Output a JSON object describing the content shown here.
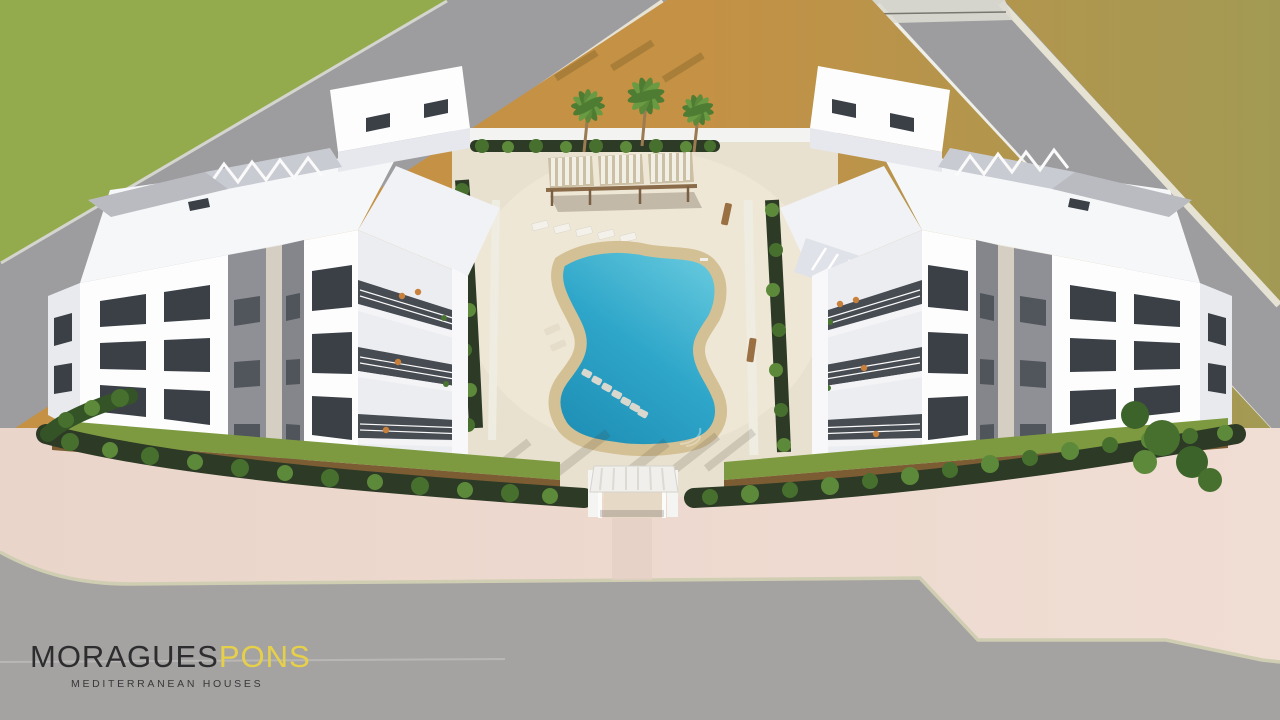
{
  "branding": {
    "wordmark_primary": "MORAGUES",
    "wordmark_secondary": "PONS",
    "tagline": "MEDITERRANEAN HOUSES"
  },
  "scene": {
    "type": "aerial 3D architectural rendering",
    "description": "Bird's-eye render of a Mediterranean residential complex: two white three-storey apartment buildings facing a central courtyard with a free-form swimming pool, sun loungers, a triple-bay pergola and palm trees; perimeter hedges and lawns, pink paved sidewalk and grey roads around the plot, golden fields and a green lawn beyond the upper roads.",
    "elements": [
      "left apartment building",
      "right apartment building",
      "swimming pool",
      "pool deck",
      "pergola",
      "palm trees",
      "sun loungers",
      "entrance gate",
      "perimeter hedge",
      "gardens",
      "roads",
      "crosswalk",
      "lawn",
      "fields"
    ],
    "palette": {
      "field_gold": "#c49145",
      "field_olive": "#a29a54",
      "field_patch": "#b7ba78",
      "lawn_green": "#93ab4c",
      "road_gray": "#9d9da0",
      "road_gray_bottom": "#a5a3a1",
      "curb_light": "#e6e2d4",
      "curb_line": "#cfcdb2",
      "pavement_pink": "#f0ddd3",
      "deck_beige": "#e9e1cf",
      "deck_light": "#f3ebdb",
      "pool_border": "#d3c094",
      "pool_blue": "#2ea6c9",
      "pool_blue_light": "#64c8dd",
      "pool_blue_deep": "#1f8fb5",
      "building_white": "#fdfdfe",
      "building_shade": "#ebedf1",
      "building_side": "#e0e2e7",
      "roof_white": "#f6f7f9",
      "roof_gravel": "#babbc1",
      "slat_gray": "#c9cbd2",
      "window_dark": "#3b4046",
      "glass_dark": "#474c53",
      "accent_gray": "#8e9096",
      "accent_beige": "#d5cec2",
      "hedge_dark": "#2c3a26",
      "hedge_mid": "#47702f",
      "hedge_light": "#5d8a3a",
      "garden_grass": "#7e9a40",
      "soil_brown": "#7b5c33",
      "wood_brown": "#8a6b4a",
      "bench_wood": "#9a6f42",
      "canopy_stripe": "#f2efe6",
      "canopy_base": "#cbbfa4",
      "chair_orange": "#c8803a",
      "plant_green": "#4a7431",
      "logo_dark": "#2d2d2f",
      "logo_yellow": "#e7d049",
      "tagline_dark": "#38383a"
    }
  }
}
